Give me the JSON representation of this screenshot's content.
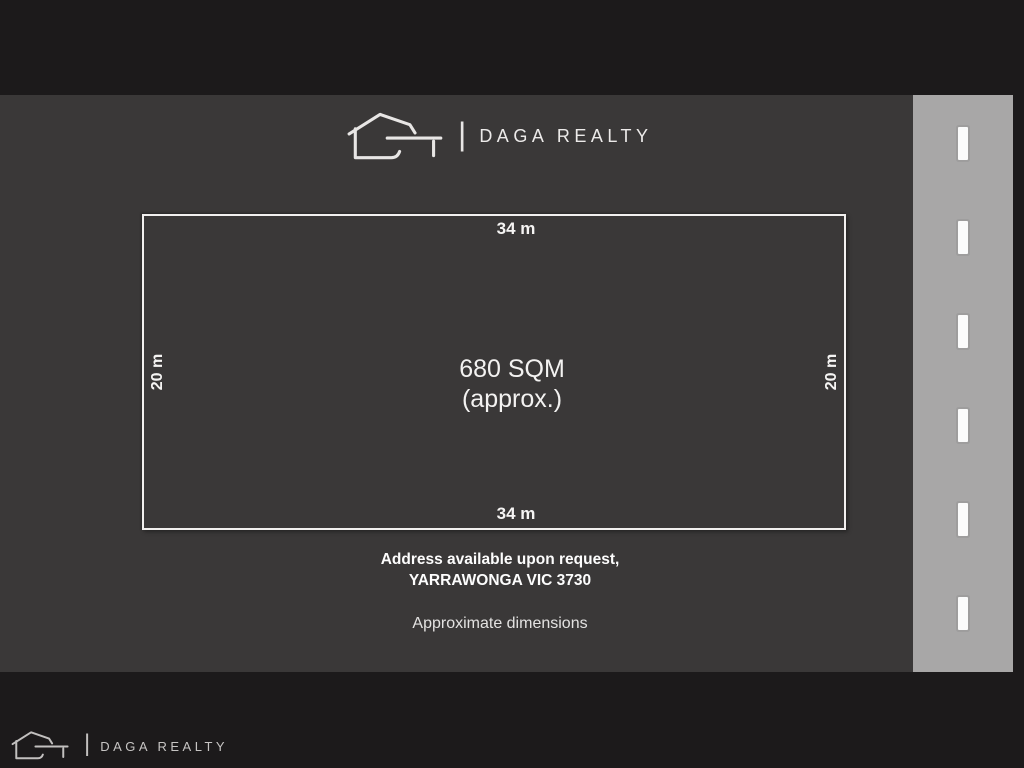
{
  "header": {
    "brand": "DAGA REALTY",
    "separator": "|"
  },
  "footer": {
    "brand": "DAGA REALTY",
    "separator": "|"
  },
  "parcel": {
    "top_dimension": "34 m",
    "bottom_dimension": "34 m",
    "left_dimension": "20 m",
    "right_dimension": "20 m",
    "area_line1": "680 SQM",
    "area_line2": "(approx.)"
  },
  "address": {
    "line1": "Address available upon request,",
    "line2": "YARRAWONGA VIC 3730"
  },
  "note": "Approximate dimensions",
  "road": {
    "dash_count": 6
  },
  "colors": {
    "frame": "#1c1a1b",
    "panel": "#3a3838",
    "road": "#a8a7a7",
    "line": "#f2f0ef",
    "text": "#fdfdfd"
  }
}
